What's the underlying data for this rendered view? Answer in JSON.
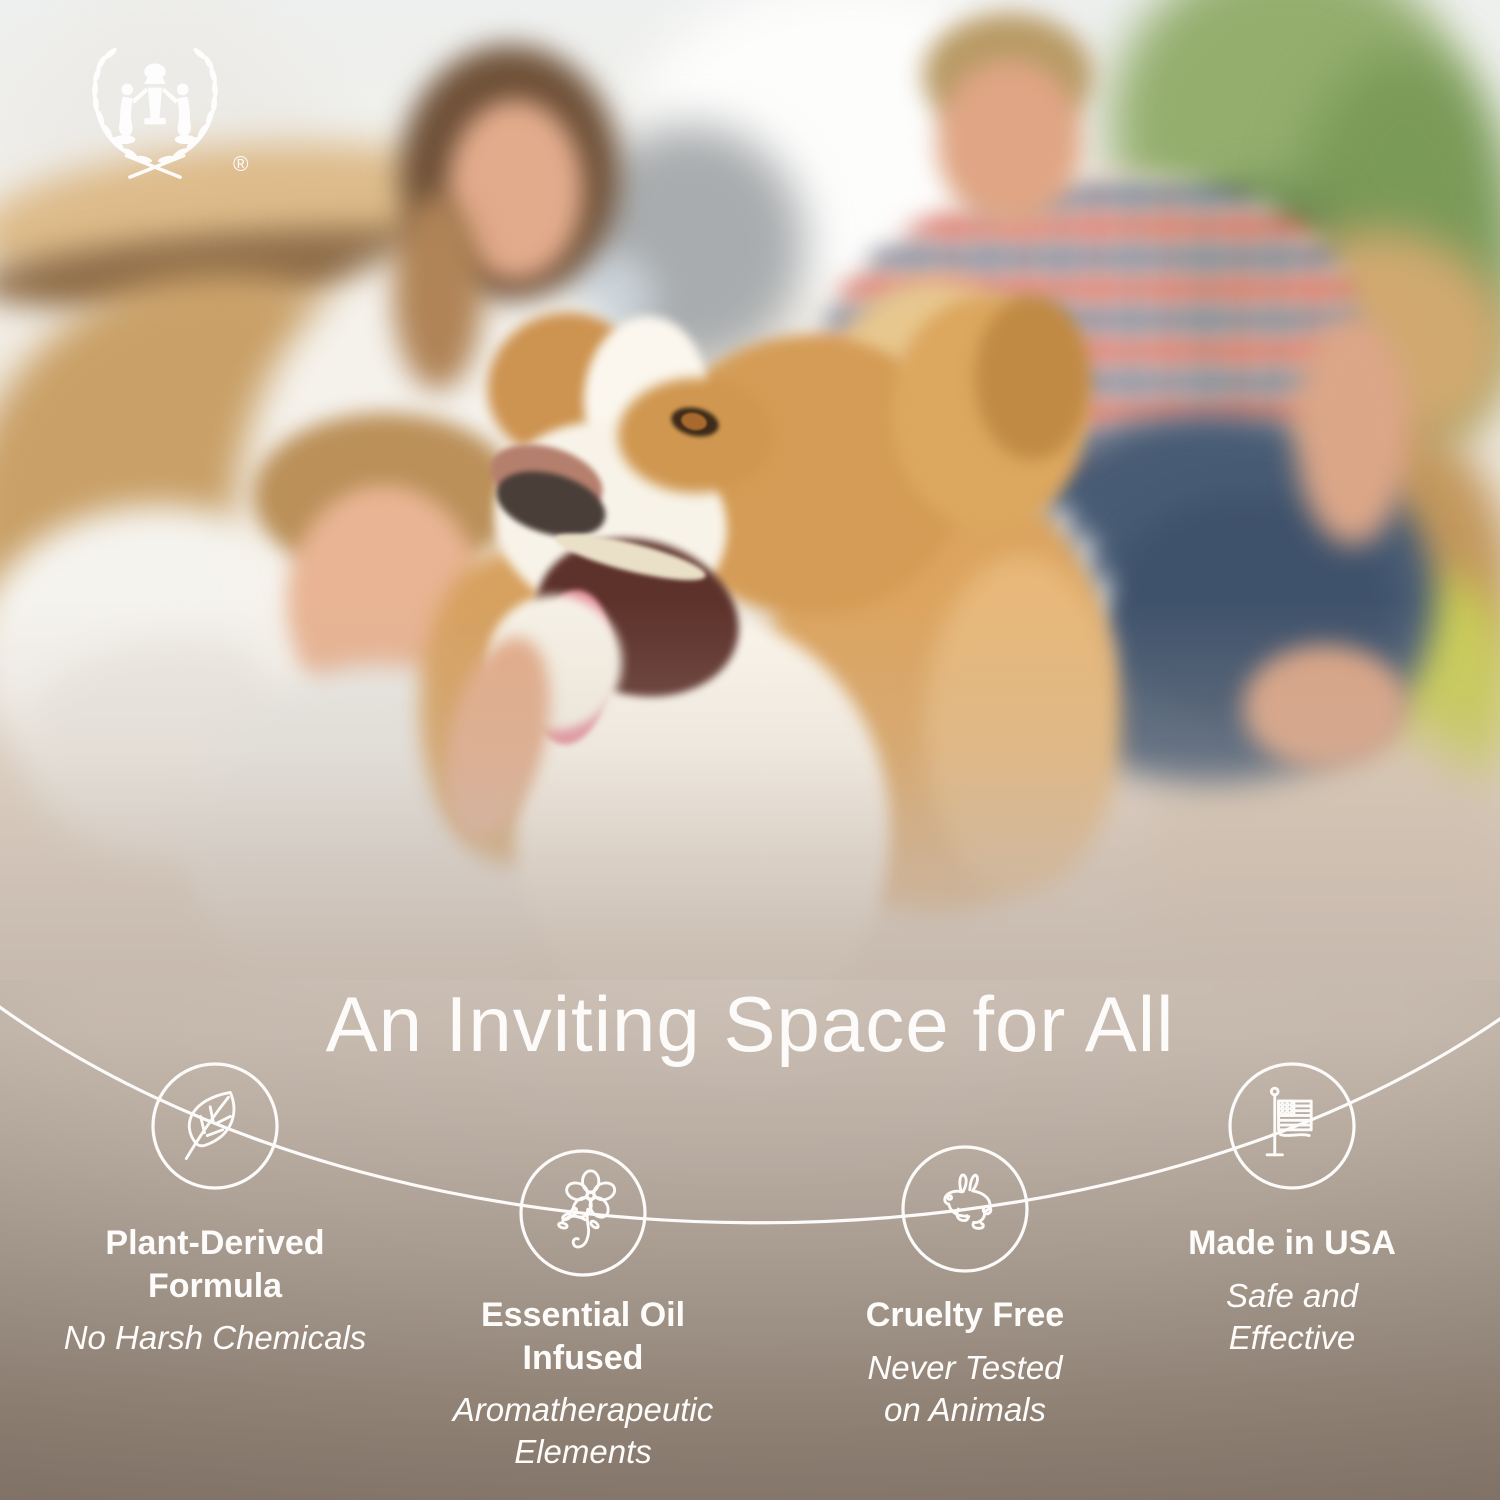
{
  "brand": {
    "logo_icon": "laurel-wreath-with-two-figures-and-urn",
    "registered_mark": "®"
  },
  "heading": {
    "text": "An Inviting Space for All"
  },
  "features": [
    {
      "icon": "leaf-icon",
      "title": "Plant-Derived Formula",
      "subtitle": "No Harsh Chemicals"
    },
    {
      "icon": "flower-icon",
      "title": "Essential Oil Infused",
      "subtitle": "Aromatherapeutic Elements"
    },
    {
      "icon": "rabbit-icon",
      "title": "Cruelty Free",
      "subtitle": "Never Tested on Animals"
    },
    {
      "icon": "us-flag-icon",
      "title": "Made in USA",
      "subtitle": "Safe and Effective"
    }
  ],
  "photo": {
    "description": "Blurred living-room scene of a family of four among moving boxes and a houseplant, with a smiling tan-and-white border collie dog in focus at the center"
  },
  "colors": {
    "text": "#fdfcfa",
    "connector_line": "#fcfbf9",
    "panel_top": "#c5b8ad",
    "panel_bottom": "#897b6f"
  }
}
